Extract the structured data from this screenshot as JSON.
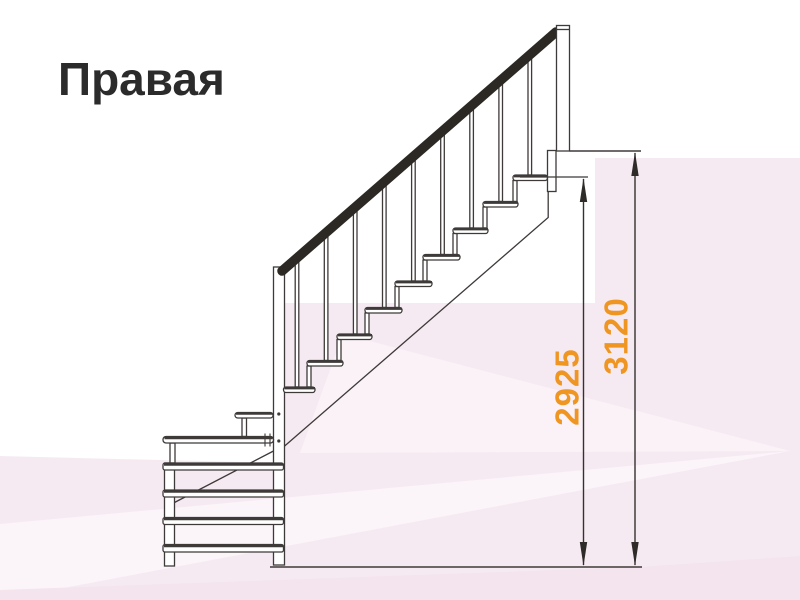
{
  "title": "Правая",
  "diagram": {
    "type": "staircase-right-side-view",
    "measurements": [
      {
        "id": "height-to-top-step",
        "value": "2925"
      },
      {
        "id": "height-floor-to-floor",
        "value": "3120"
      }
    ]
  },
  "colors": {
    "dimension_text": "#EF9522",
    "outline": "#3E3A39",
    "handrail": "#2C2824",
    "background_tint": "#F6EAF2",
    "title_text": "#2B2B2B"
  }
}
